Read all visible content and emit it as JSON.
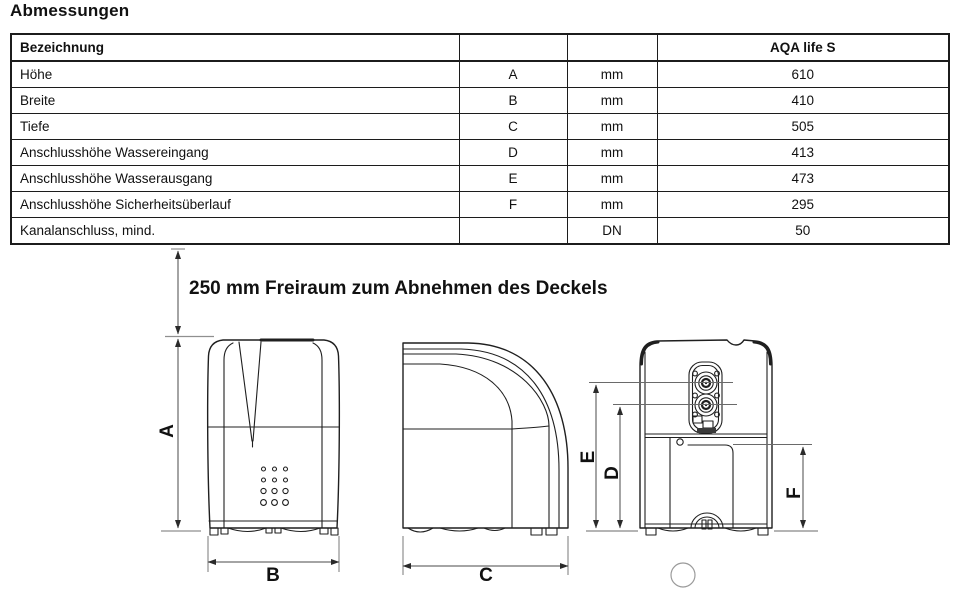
{
  "page": {
    "title": "Abmessungen"
  },
  "table": {
    "columns": [
      "Bezeichnung",
      "",
      "",
      "AQA life S"
    ],
    "rows": [
      {
        "label": "Höhe",
        "symbol": "A",
        "unit": "mm",
        "value": "610"
      },
      {
        "label": "Breite",
        "symbol": "B",
        "unit": "mm",
        "value": "410"
      },
      {
        "label": "Tiefe",
        "symbol": "C",
        "unit": "mm",
        "value": "505"
      },
      {
        "label": "Anschlusshöhe Wassereingang",
        "symbol": "D",
        "unit": "mm",
        "value": "413"
      },
      {
        "label": "Anschlusshöhe Wasserausgang",
        "symbol": "E",
        "unit": "mm",
        "value": "473"
      },
      {
        "label": "Anschlusshöhe Sicherheitsüberlauf",
        "symbol": "F",
        "unit": "mm",
        "value": "295"
      },
      {
        "label": "Kanalanschluss, mind.",
        "symbol": "",
        "unit": "DN",
        "value": "50"
      }
    ]
  },
  "diagram": {
    "clearance_note": "250 mm Freiraum zum Abnehmen des Deckels",
    "labels": {
      "a": "A",
      "b": "B",
      "c": "C",
      "d": "D",
      "e": "E",
      "f": "F"
    },
    "colors": {
      "outline": "#1f1f1f",
      "dimension": "#4a4a4a"
    }
  }
}
